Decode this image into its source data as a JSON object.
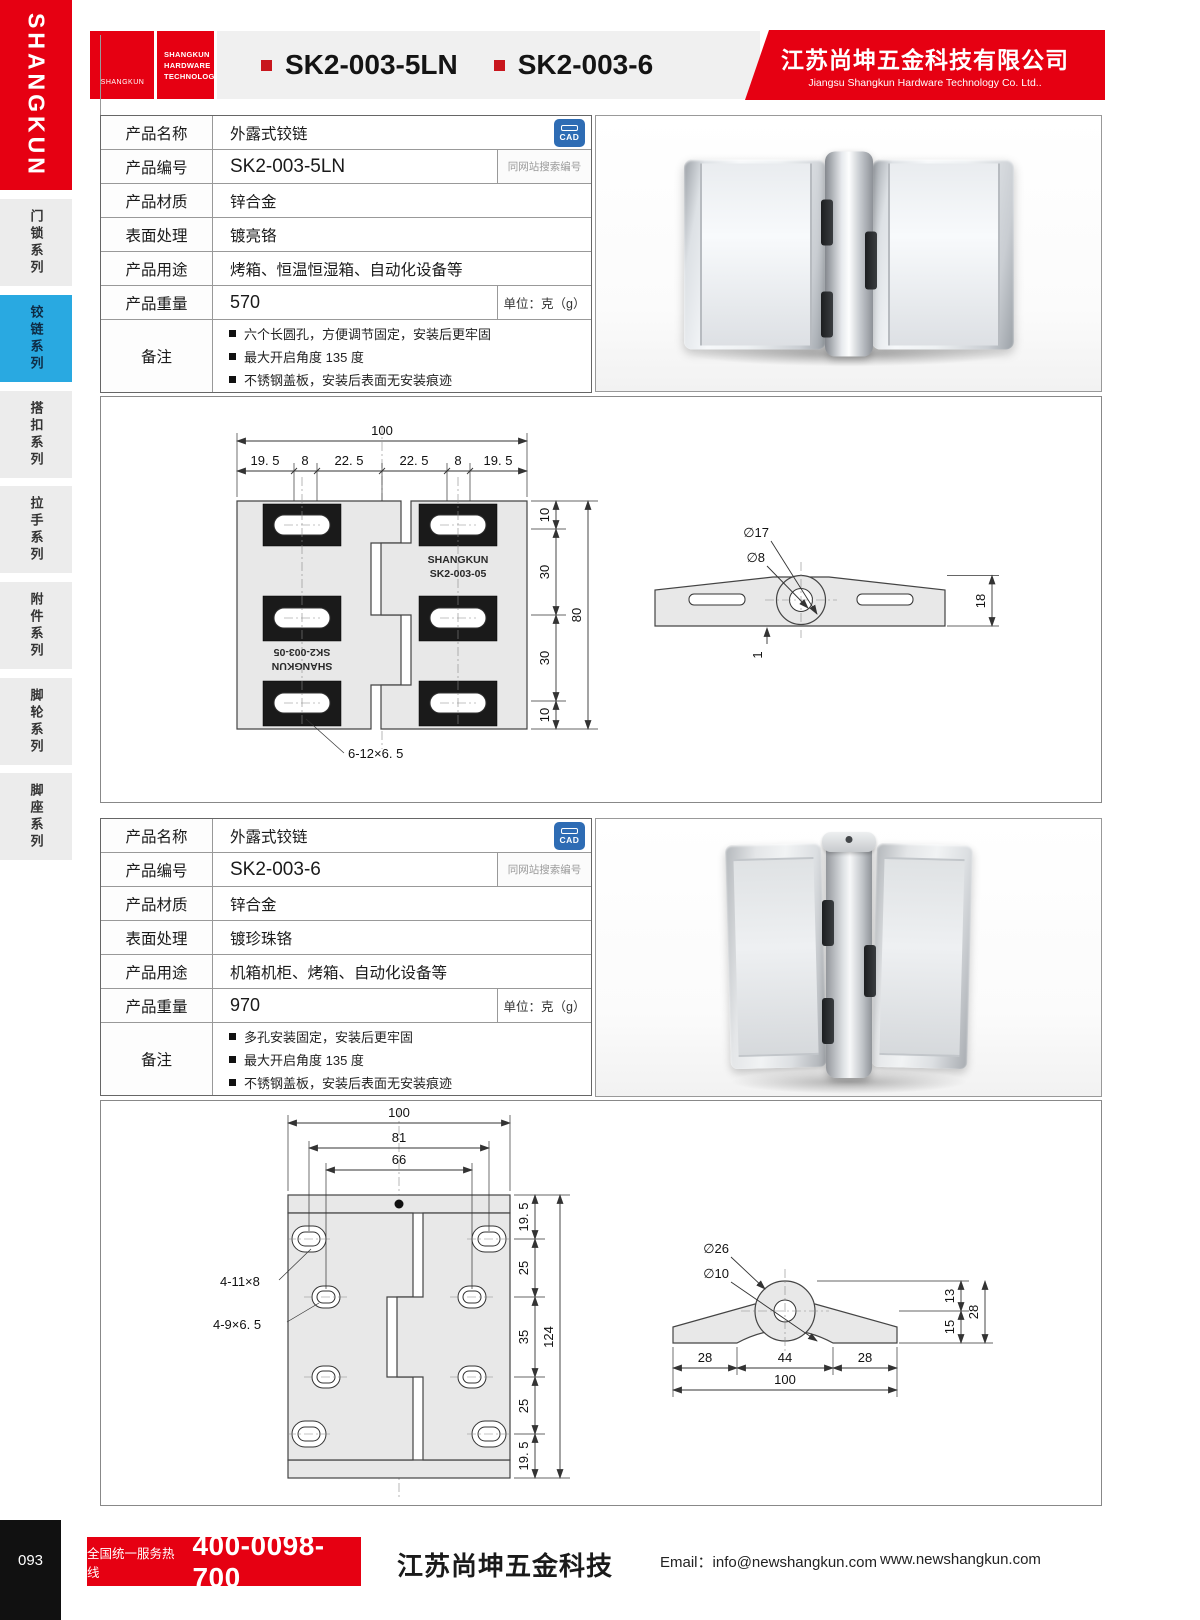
{
  "colors": {
    "brand_red": "#e60012",
    "active_blue": "#29a9e1",
    "cad_blue": "#2e6cb4"
  },
  "sidebar": {
    "logo_vertical": "SHANGKUN",
    "items": [
      {
        "label": "门锁系列"
      },
      {
        "label": "铰链系列"
      },
      {
        "label": "搭扣系列"
      },
      {
        "label": "拉手系列"
      },
      {
        "label": "附件系列"
      },
      {
        "label": "脚轮系列"
      },
      {
        "label": "脚座系列"
      }
    ]
  },
  "header": {
    "logo_sk": "SK",
    "logo_sk_sub": "SHANGKUN",
    "logo_lines": [
      "SHANGKUN",
      "HARDWARE",
      "TECHNOLOGY"
    ],
    "codes": [
      "SK2-003-5LN",
      "SK2-003-6"
    ],
    "company_cn": "江苏尚坤五金科技有限公司",
    "company_en": "Jiangsu Shangkun Hardware Technology Co. Ltd.."
  },
  "products": [
    {
      "cad_badge": "CAD",
      "specs": {
        "name_label": "产品名称",
        "name": "外露式铰链",
        "code_label": "产品编号",
        "code": "SK2-003-5LN",
        "code_note": "同网站搜索编号",
        "material_label": "产品材质",
        "material": "锌合金",
        "finish_label": "表面处理",
        "finish": "镀亮铬",
        "usage_label": "产品用途",
        "usage": "烤箱、恒温恒湿箱、自动化设备等",
        "weight_label": "产品重量",
        "weight": "570",
        "weight_unit": "单位：克（g）",
        "remark_label": "备注",
        "remarks": [
          "六个长圆孔，方便调节固定，安装后更牢固",
          "最大开启角度 135 度",
          "不锈钢盖板，安装后表面无安装痕迹"
        ]
      }
    },
    {
      "cad_badge": "CAD",
      "specs": {
        "name_label": "产品名称",
        "name": "外露式铰链",
        "code_label": "产品编号",
        "code": "SK2-003-6",
        "code_note": "同网站搜索编号",
        "material_label": "产品材质",
        "material": "锌合金",
        "finish_label": "表面处理",
        "finish": "镀珍珠铬",
        "usage_label": "产品用途",
        "usage": "机箱机柜、烤箱、自动化设备等",
        "weight_label": "产品重量",
        "weight": "970",
        "weight_unit": "单位：克（g）",
        "remark_label": "备注",
        "remarks": [
          "多孔安装固定，安装后更牢固",
          "最大开启角度 135 度",
          "不锈钢盖板，安装后表面无安装痕迹"
        ]
      }
    }
  ],
  "drawings": {
    "d1": {
      "front": {
        "w_total": "100",
        "w_subs": [
          "19. 5",
          "8",
          "22. 5",
          "22. 5",
          "8",
          "19. 5"
        ],
        "h_segs": [
          "10",
          "30",
          "30",
          "10"
        ],
        "h_total": "80",
        "hole_note": "6-12×6. 5",
        "brand_top": "SHANGKUN",
        "brand_bottom": "SK2-003-05"
      },
      "side": {
        "dia_outer": "∅17",
        "dia_inner": "∅8",
        "height": "18",
        "step": "1"
      }
    },
    "d2": {
      "front": {
        "w_total": "100",
        "w_mid": "81",
        "w_inner": "66",
        "note_big": "4-11×8",
        "note_small": "4-9×6. 5",
        "h_segs": [
          "19. 5",
          "25",
          "35",
          "25",
          "19. 5"
        ],
        "h_total": "124"
      },
      "side": {
        "dia_outer": "∅26",
        "dia_inner": "∅10",
        "h_top": "13",
        "h_bottom": "15",
        "h_total": "28",
        "w_segs": [
          "28",
          "44",
          "28"
        ],
        "w_total": "100"
      }
    }
  },
  "footer": {
    "page_number": "093",
    "hotline_label": "全国统一服务热线",
    "hotline_number": "400-0098-700",
    "company": "江苏尚坤五金科技",
    "email_label": "Email：",
    "email": "info@newshangkun.com",
    "website": "www.newshangkun.com"
  }
}
